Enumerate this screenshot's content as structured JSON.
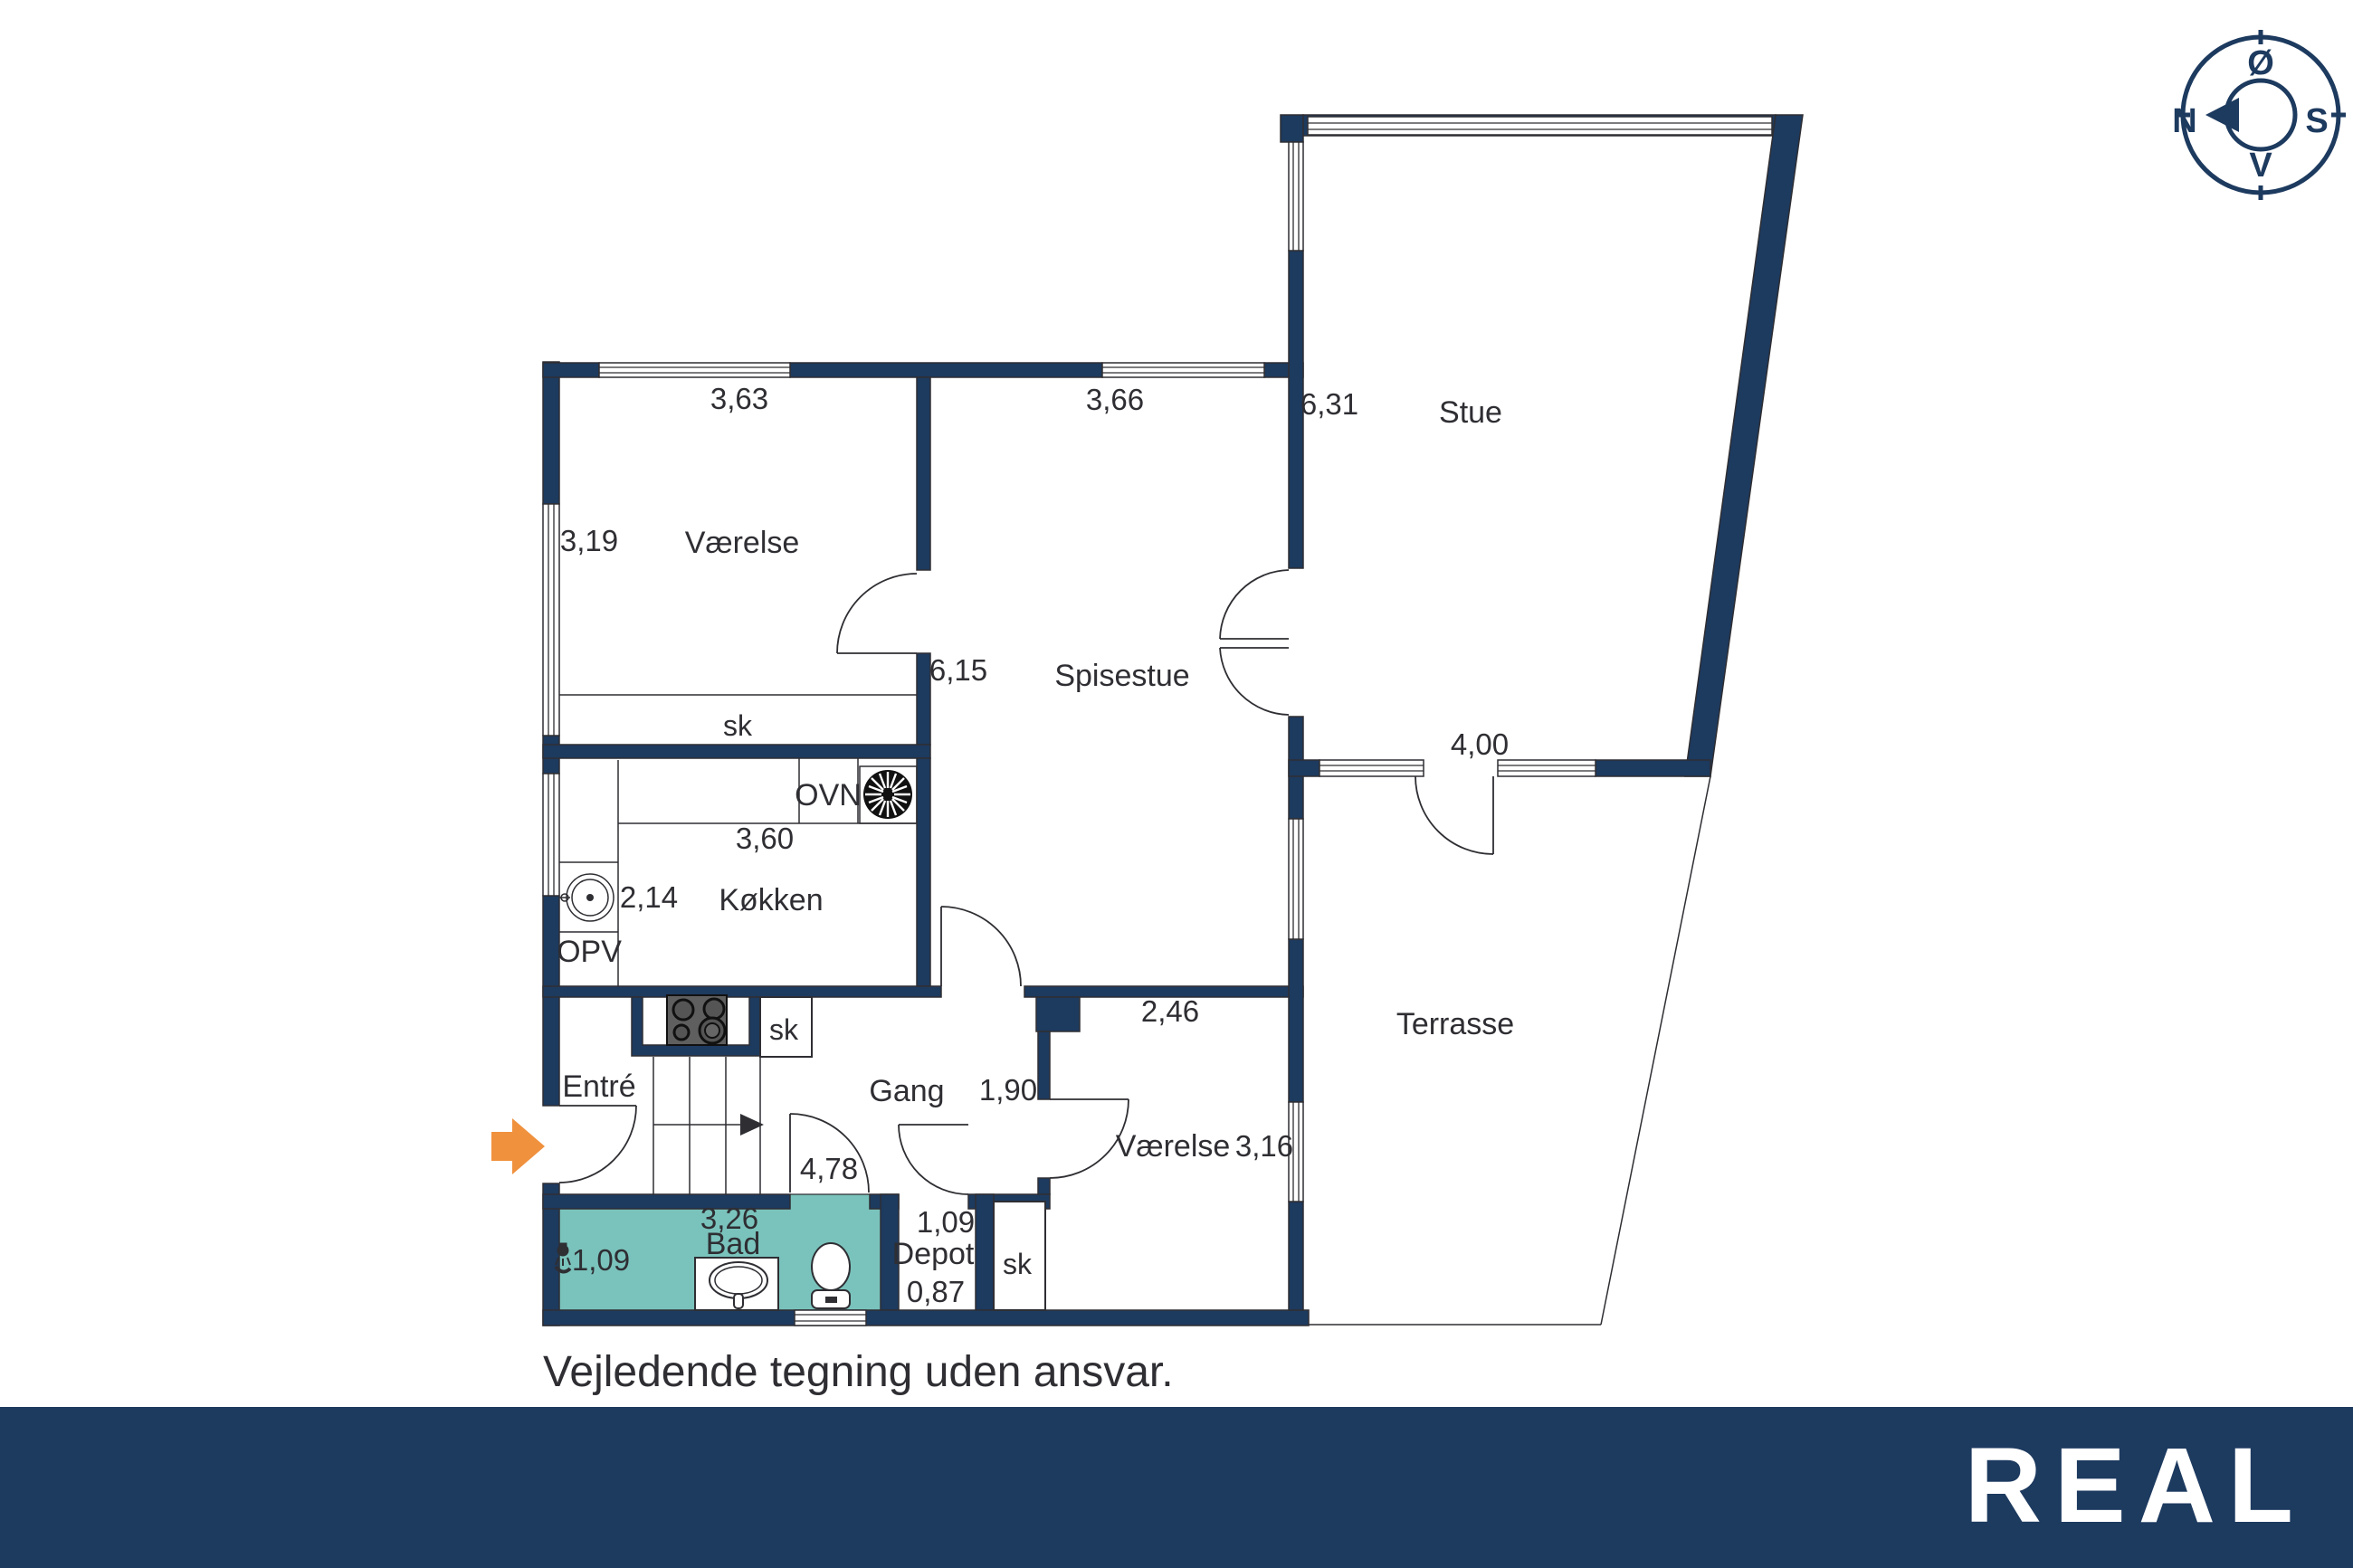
{
  "plan": {
    "disclaimer": "Vejledende tegning uden ansvar.",
    "rooms": {
      "bedroom_top": {
        "name": "Værelse",
        "dim_w": "3,63",
        "dim_h": "3,19",
        "closet": "sk"
      },
      "dining_room": {
        "name": "Spisestue",
        "dim_w": "3,66",
        "dim_h": "6,15"
      },
      "living_room": {
        "name": "Stue",
        "dim_h": "6,31"
      },
      "terrace": {
        "name": "Terrasse",
        "dim_w": "4,00"
      },
      "kitchen": {
        "name": "Køkken",
        "dim_w": "3,60",
        "dim_h": "2,14",
        "oven_label": "OVN",
        "dishwasher_label": "OPV",
        "closet": "sk"
      },
      "entry": {
        "name": "Entré"
      },
      "hallway": {
        "name": "Gang",
        "dim_w": "1,90",
        "dim_len": "4,78"
      },
      "bedroom_bottom": {
        "name": "Værelse",
        "dim_w": "2,46",
        "dim_h": "3,16",
        "closet": "sk"
      },
      "bathroom": {
        "name": "Bad",
        "dim_w": "3,26",
        "dim_h": "1,09"
      },
      "depot": {
        "name": "Depot",
        "dim_w": "0,87",
        "dim_h": "1,09"
      }
    },
    "compass": {
      "north": "N",
      "south": "S",
      "east": "Ø",
      "west": "V"
    }
  },
  "footer": {
    "brand": "REAL"
  },
  "colors": {
    "wall": "#1d3a5f",
    "line": "#2e2e33",
    "text": "#2e2e33",
    "bath_floor": "#7ac3bc",
    "arrow": "#f0913e",
    "footer_bg": "#1d3a5f",
    "footer_text": "#ffffff",
    "stove": "#5f5f5f"
  }
}
